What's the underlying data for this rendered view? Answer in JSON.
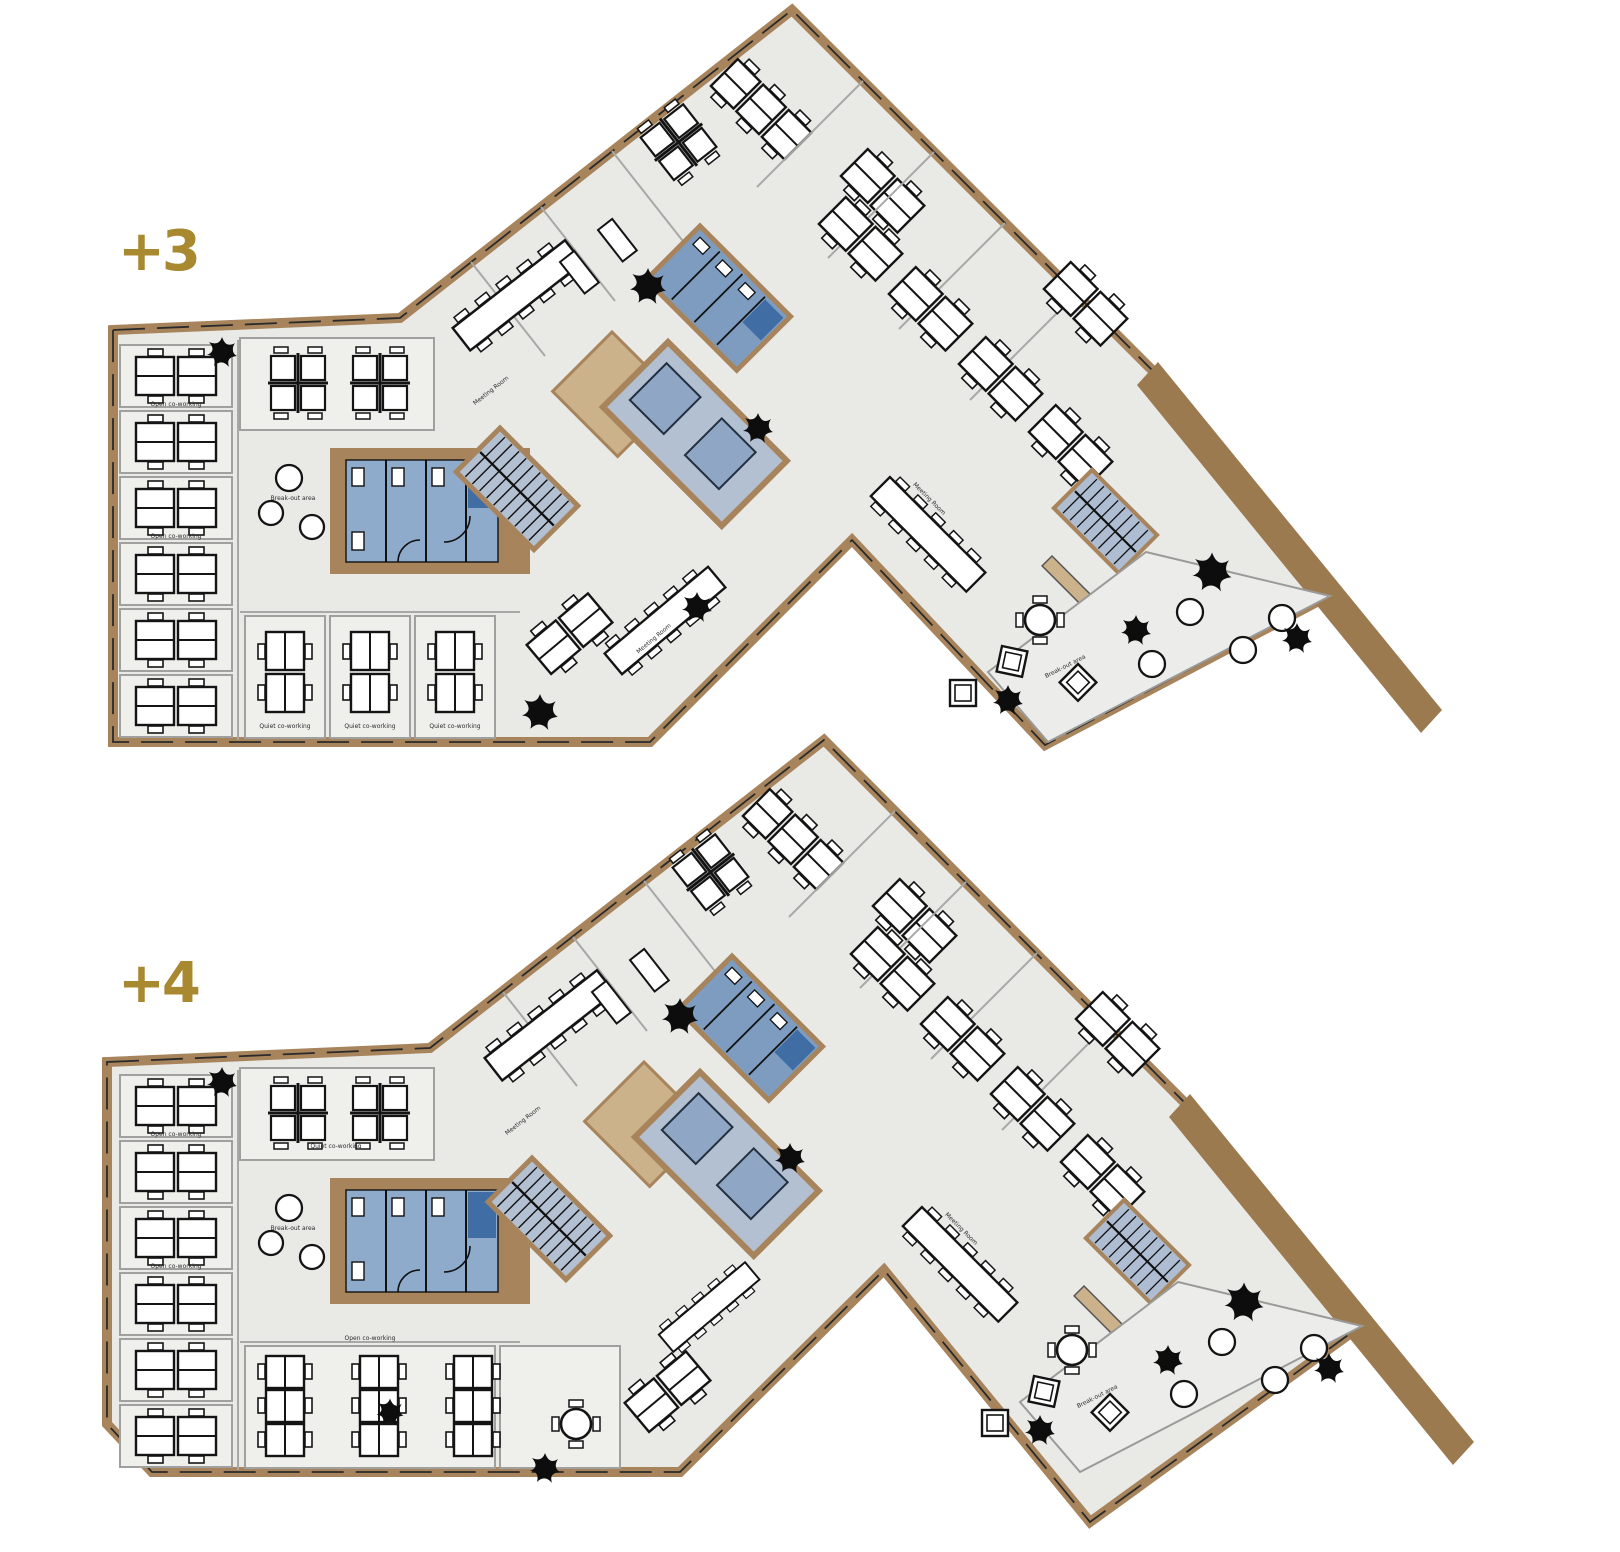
{
  "page": {
    "title": "Office floor plans +3 and +4",
    "background": "#ffffff"
  },
  "colors": {
    "floor": "#e9e9e6",
    "room_fill": "#efefec",
    "room_stroke": "#a0a09e",
    "wall_tan": "#a7845b",
    "wall_tan_light": "#cbb28b",
    "balcony_band": "#9c7a50",
    "accent_gold": "#a8892f",
    "wet_area_light": "#8fabcb",
    "wet_area_mid": "#7d9cc0",
    "wet_area_dark": "#3f6da4",
    "core_gray_blue": "#b3c0d2",
    "furniture_line": "#141414"
  },
  "floors": [
    {
      "id": "plus3",
      "label": "+3",
      "areas": [
        "Open co-working",
        "Quiet co-working",
        "Meeting Room",
        "Break-out area"
      ]
    },
    {
      "id": "plus4",
      "label": "+4",
      "areas": [
        "Open co-working",
        "Quiet co-working",
        "Meeting Room",
        "Break-out area"
      ]
    }
  ],
  "labels": {
    "open_coworking": "Open co-working",
    "quiet_coworking": "Quiet co-working",
    "meeting_room": "Meeting Room",
    "break_out_area": "Break-out area"
  }
}
